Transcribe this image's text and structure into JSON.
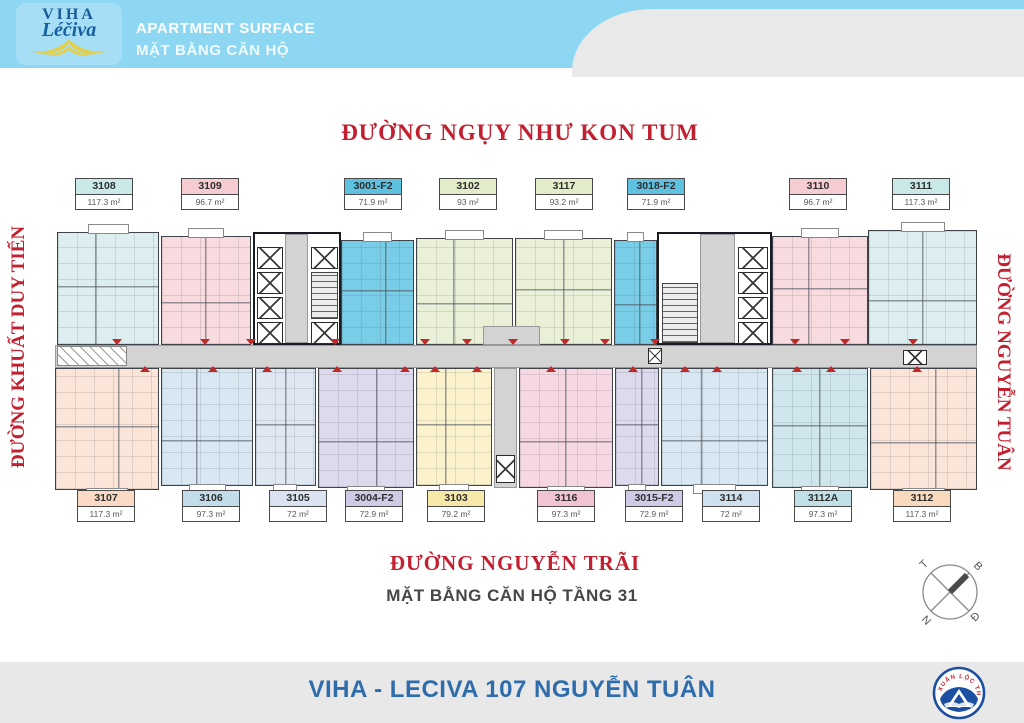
{
  "header": {
    "logo_line1": "VIHA",
    "logo_line2": "Léčiva",
    "title_en": "APARTMENT SURFACE",
    "title_vi": "MẶT BẰNG CĂN HỘ",
    "band_color": "#8ed7f2"
  },
  "streets": {
    "top": "ĐƯỜNG NGỤY NHƯ KON TUM",
    "left": "ĐƯỜNG KHUẤT DUY TIẾN",
    "right": "ĐƯỜNG NGUYỄN TUÂN",
    "bottom": "ĐƯỜNG NGUYỄN TRÃI"
  },
  "plan": {
    "caption": "MẶT BẰNG CĂN HỘ TẦNG 31",
    "corridor": {
      "x": 55,
      "y": 345,
      "w": 922,
      "h": 23,
      "door_markers_top": [
        112,
        200,
        246,
        330,
        420,
        462,
        508,
        560,
        600,
        650,
        790,
        840,
        908
      ],
      "door_markers_bottom": [
        140,
        208,
        262,
        332,
        400,
        430,
        472,
        546,
        628,
        680,
        712,
        792,
        826,
        912
      ]
    },
    "units": [
      {
        "id": "3108",
        "row": "top",
        "area": "117.3 m²",
        "fill": "#dceef0",
        "header_fill": "#c9e9e9",
        "rect": {
          "x": 57,
          "y": 232,
          "w": 102,
          "h": 113
        },
        "label": {
          "x": 75,
          "y": 178
        }
      },
      {
        "id": "3109",
        "row": "top",
        "area": "96.7 m²",
        "fill": "#f7dbde",
        "header_fill": "#f5ccd2",
        "rect": {
          "x": 161,
          "y": 236,
          "w": 90,
          "h": 109
        },
        "label": {
          "x": 181,
          "y": 178
        }
      },
      {
        "id": "3001-F2",
        "row": "top",
        "area": "71.9 m²",
        "fill": "#79cde6",
        "header_fill": "#5ec1e0",
        "rect": {
          "x": 341,
          "y": 240,
          "w": 73,
          "h": 105
        },
        "label": {
          "x": 344,
          "y": 178
        }
      },
      {
        "id": "3102",
        "row": "top",
        "area": "93 m²",
        "fill": "#eaf0d8",
        "header_fill": "#e3ecc8",
        "rect": {
          "x": 416,
          "y": 238,
          "w": 97,
          "h": 107
        },
        "label": {
          "x": 439,
          "y": 178
        }
      },
      {
        "id": "3117",
        "row": "top",
        "area": "93.2 m²",
        "fill": "#eaf0d8",
        "header_fill": "#e3ecc8",
        "rect": {
          "x": 515,
          "y": 238,
          "w": 97,
          "h": 107
        },
        "label": {
          "x": 535,
          "y": 178
        }
      },
      {
        "id": "3018-F2",
        "row": "top",
        "area": "71.9 m²",
        "fill": "#79cde6",
        "header_fill": "#5ec1e0",
        "rect": {
          "x": 614,
          "y": 240,
          "w": 43,
          "h": 105
        },
        "label": {
          "x": 627,
          "y": 178
        }
      },
      {
        "id": "3110",
        "row": "top",
        "area": "96.7 m²",
        "fill": "#f7dbde",
        "header_fill": "#f5ccd2",
        "rect": {
          "x": 772,
          "y": 236,
          "w": 96,
          "h": 109
        },
        "label": {
          "x": 789,
          "y": 178
        }
      },
      {
        "id": "3111",
        "row": "top",
        "area": "117.3 m²",
        "fill": "#dceef0",
        "header_fill": "#c9e9e9",
        "rect": {
          "x": 868,
          "y": 230,
          "w": 109,
          "h": 115
        },
        "label": {
          "x": 892,
          "y": 178
        }
      },
      {
        "id": "3107",
        "row": "bottom",
        "area": "117.3 m²",
        "fill": "#fbe5d8",
        "header_fill": "#fad9c5",
        "rect": {
          "x": 55,
          "y": 368,
          "w": 104,
          "h": 122
        },
        "label": {
          "x": 77,
          "y": 490
        }
      },
      {
        "id": "3106",
        "row": "bottom",
        "area": "97.3 m²",
        "fill": "#d8e7f1",
        "header_fill": "#c2dcea",
        "rect": {
          "x": 161,
          "y": 368,
          "w": 92,
          "h": 118
        },
        "label": {
          "x": 182,
          "y": 490
        }
      },
      {
        "id": "3105",
        "row": "bottom",
        "area": "72 m²",
        "fill": "#dfe7f3",
        "header_fill": "#dbe3f2",
        "rect": {
          "x": 255,
          "y": 368,
          "w": 61,
          "h": 118
        },
        "label": {
          "x": 269,
          "y": 490
        }
      },
      {
        "id": "3004-F2",
        "row": "bottom",
        "area": "72.9 m²",
        "fill": "#dedaed",
        "header_fill": "#cecbe6",
        "rect": {
          "x": 318,
          "y": 368,
          "w": 96,
          "h": 120
        },
        "label": {
          "x": 345,
          "y": 490
        }
      },
      {
        "id": "3103",
        "row": "bottom",
        "area": "79.2 m²",
        "fill": "#fbf2cc",
        "header_fill": "#f6e8a9",
        "rect": {
          "x": 416,
          "y": 368,
          "w": 76,
          "h": 118
        },
        "label": {
          "x": 427,
          "y": 490
        }
      },
      {
        "id": "3116",
        "row": "bottom",
        "area": "97.3 m²",
        "fill": "#f7d8e2",
        "header_fill": "#f2c4d3",
        "rect": {
          "x": 519,
          "y": 368,
          "w": 94,
          "h": 120
        },
        "label": {
          "x": 537,
          "y": 490
        }
      },
      {
        "id": "3015-F2",
        "row": "bottom",
        "area": "72.9 m²",
        "fill": "#dedaed",
        "header_fill": "#cecbe6",
        "rect": {
          "x": 615,
          "y": 368,
          "w": 44,
          "h": 118
        },
        "label": {
          "x": 625,
          "y": 490
        }
      },
      {
        "id": "3114",
        "row": "bottom",
        "area": "72 m²",
        "fill": "#d8e7f1",
        "header_fill": "#cfe0ee",
        "rect": {
          "x": 661,
          "y": 368,
          "w": 107,
          "h": 118
        },
        "label": {
          "x": 702,
          "y": 490
        }
      },
      {
        "id": "3112A",
        "row": "bottom",
        "area": "97.3 m²",
        "fill": "#cfe6ec",
        "header_fill": "#c0e0e8",
        "rect": {
          "x": 772,
          "y": 368,
          "w": 96,
          "h": 120
        },
        "label": {
          "x": 794,
          "y": 490
        }
      },
      {
        "id": "3112",
        "row": "bottom",
        "area": "117.3 m²",
        "fill": "#fbe5d8",
        "header_fill": "#f8d9be",
        "rect": {
          "x": 870,
          "y": 368,
          "w": 107,
          "h": 122
        },
        "label": {
          "x": 893,
          "y": 490
        }
      }
    ],
    "cores": {
      "blocks": [
        {
          "x": 253,
          "y": 232,
          "w": 88,
          "h": 113
        },
        {
          "x": 657,
          "y": 232,
          "w": 115,
          "h": 113
        }
      ],
      "gray": [
        {
          "x": 285,
          "y": 234,
          "w": 23,
          "h": 109
        },
        {
          "x": 700,
          "y": 234,
          "w": 35,
          "h": 109
        },
        {
          "x": 494,
          "y": 368,
          "w": 23,
          "h": 120
        },
        {
          "x": 483,
          "y": 326,
          "w": 57,
          "h": 19
        }
      ],
      "elevators": [
        {
          "x": 257,
          "y": 247,
          "w": 26,
          "h": 22
        },
        {
          "x": 257,
          "y": 272,
          "w": 26,
          "h": 22
        },
        {
          "x": 257,
          "y": 297,
          "w": 26,
          "h": 22
        },
        {
          "x": 257,
          "y": 322,
          "w": 26,
          "h": 22
        },
        {
          "x": 311,
          "y": 247,
          "w": 27,
          "h": 22
        },
        {
          "x": 311,
          "y": 322,
          "w": 27,
          "h": 22
        },
        {
          "x": 738,
          "y": 247,
          "w": 30,
          "h": 22
        },
        {
          "x": 738,
          "y": 272,
          "w": 30,
          "h": 22
        },
        {
          "x": 738,
          "y": 297,
          "w": 30,
          "h": 22
        },
        {
          "x": 738,
          "y": 322,
          "w": 30,
          "h": 22
        },
        {
          "x": 648,
          "y": 348,
          "w": 14,
          "h": 16
        },
        {
          "x": 903,
          "y": 350,
          "w": 24,
          "h": 15
        },
        {
          "x": 496,
          "y": 455,
          "w": 19,
          "h": 28
        }
      ],
      "stairs": [
        {
          "x": 311,
          "y": 272,
          "w": 27,
          "h": 47
        },
        {
          "x": 662,
          "y": 283,
          "w": 36,
          "h": 60
        }
      ],
      "ramps": [
        {
          "x": 57,
          "y": 346,
          "w": 70,
          "h": 20
        }
      ]
    }
  },
  "compass": {
    "t": "T",
    "b": "B",
    "n": "N",
    "d": "Đ"
  },
  "footer": {
    "title": "VIHA - LECIVA 107 NGUYỄN TUÂN",
    "logo_text": "XUÂN LỘC THỌ"
  }
}
